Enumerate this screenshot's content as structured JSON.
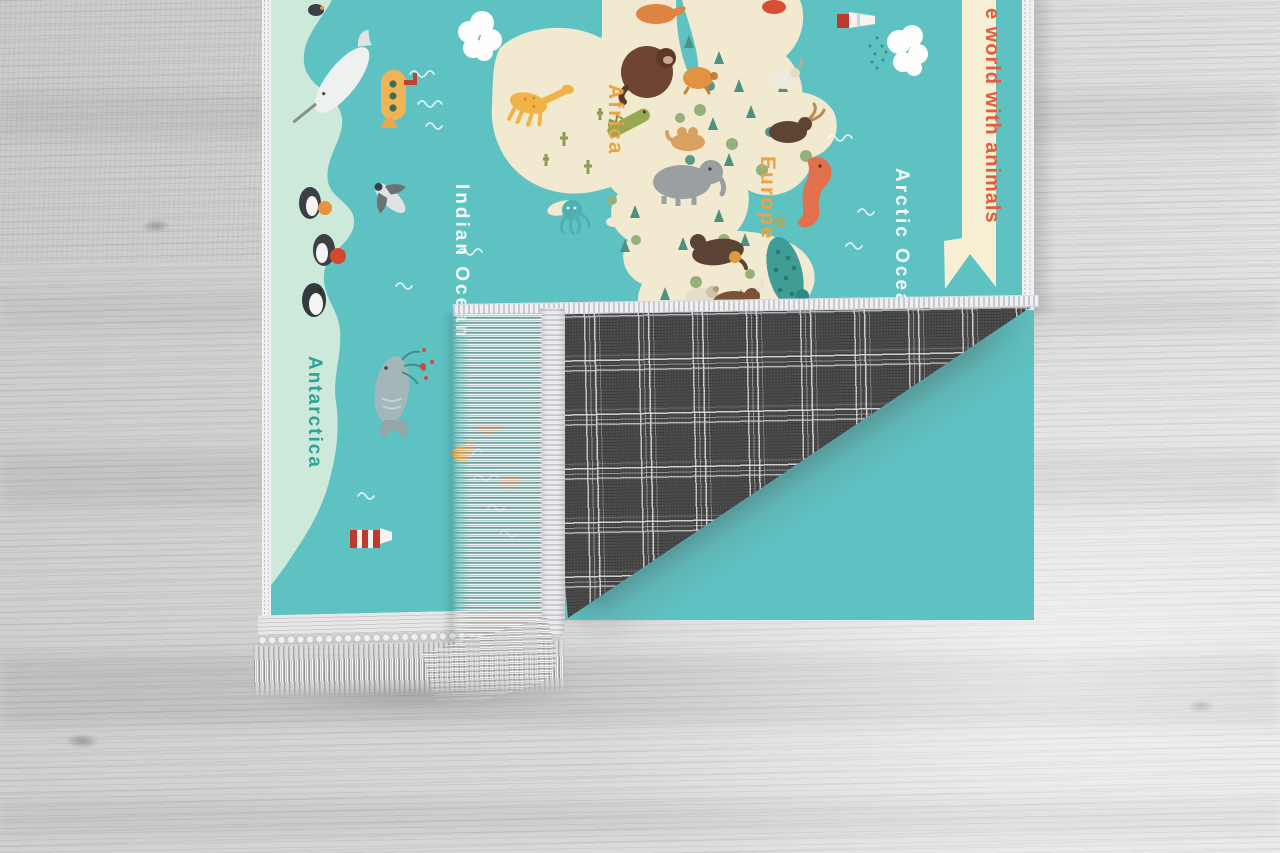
{
  "rug": {
    "ribbon": {
      "text": "e world with animals"
    },
    "labels": {
      "africa": "Africa",
      "europe": "Europe",
      "indian_ocean": "Indian Ocean",
      "arctic_ocean": "Arctic Ocean",
      "antarctica": "Antarctica"
    },
    "colors": {
      "ocean": "#5ec2c2",
      "ice": "#cde9da",
      "land": "#f1ead1",
      "continent_label": "#eda23f",
      "ocean_label": "#ffffff",
      "antarctica_label": "#2fa39a",
      "ribbon_bg": "#f6efd3",
      "ribbon_text": "#e25c3d",
      "binding": "#f1f1f4",
      "backing_base": "#474747",
      "backing_stripe": "#dddddd",
      "fringe": "#dcdcdc"
    }
  }
}
